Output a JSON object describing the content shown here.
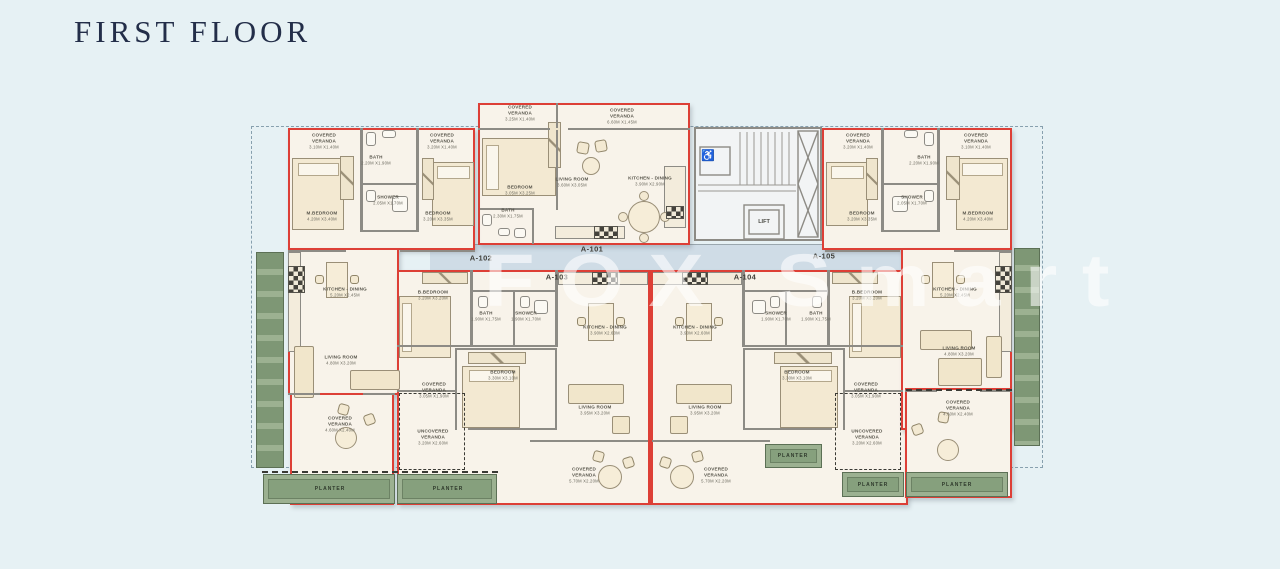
{
  "page": {
    "title": "FIRST FLOOR",
    "watermark": "FOX Smart"
  },
  "colors": {
    "background": "#e6f1f4",
    "unit_outline_red": "#dd3f36",
    "wall_gray": "#8d8b85",
    "room_fill": "#f8f3ea",
    "corridor_fill": "#cfdce6",
    "planter_green": "#9cb191",
    "planter_dark": "#7e9775",
    "title_navy": "#232e49",
    "label_gray": "#57554b",
    "watermark_white": "rgba(255,255,255,0.58)"
  },
  "core": {
    "lift_label": "LIFT",
    "wheelchair_icon": "♿"
  },
  "unit_labels": [
    {
      "text": "A-101",
      "x": 592,
      "y": 249
    },
    {
      "text": "A-102",
      "x": 481,
      "y": 258
    },
    {
      "text": "A-103",
      "x": 557,
      "y": 277
    },
    {
      "text": "A-104",
      "x": 745,
      "y": 277
    },
    {
      "text": "A-105",
      "x": 824,
      "y": 256
    }
  ],
  "planter_labels": [
    {
      "text": "PLANTER",
      "x": 330,
      "y": 489
    },
    {
      "text": "PLANTER",
      "x": 448,
      "y": 489
    },
    {
      "text": "PLANTER",
      "x": 793,
      "y": 456
    },
    {
      "text": "PLANTER",
      "x": 873,
      "y": 485
    },
    {
      "text": "PLANTER",
      "x": 957,
      "y": 485
    }
  ],
  "room_labels": [
    {
      "unit": "A-101",
      "name": "COVERED VERANDA",
      "dims": "3.25m x1.40m",
      "x": 520,
      "y": 113
    },
    {
      "unit": "A-101",
      "name": "COVERED VERANDA",
      "dims": "6.60m x1.45m",
      "x": 622,
      "y": 116
    },
    {
      "unit": "A-101",
      "name": "BEDROOM",
      "dims": "3.05m x3.25m",
      "x": 520,
      "y": 190
    },
    {
      "unit": "A-101",
      "name": "LIVING ROOM",
      "dims": "3.60m x3.05m",
      "x": 572,
      "y": 182
    },
    {
      "unit": "A-101",
      "name": "KITCHEN - DINING",
      "dims": "3.90m x2.90m",
      "x": 650,
      "y": 181
    },
    {
      "unit": "A-101",
      "name": "BATH",
      "dims": "2.30m x1.75m",
      "x": 508,
      "y": 213
    },
    {
      "unit": "A-102",
      "name": "COVERED VERANDA",
      "dims": "3.10m x1.40m",
      "x": 324,
      "y": 141
    },
    {
      "unit": "A-102",
      "name": "BATH",
      "dims": "2.20m x1.90m",
      "x": 376,
      "y": 160
    },
    {
      "unit": "A-102",
      "name": "COVERED VERANDA",
      "dims": "3.20m x1.40m",
      "x": 442,
      "y": 141
    },
    {
      "unit": "A-102",
      "name": "M.BEDROOM",
      "dims": "4.20m x3.40m",
      "x": 322,
      "y": 216
    },
    {
      "unit": "A-102",
      "name": "SHOWER",
      "dims": "2.05m x1.70m",
      "x": 388,
      "y": 200
    },
    {
      "unit": "A-102",
      "name": "BEDROOM",
      "dims": "3.20m x3.35m",
      "x": 438,
      "y": 216
    },
    {
      "unit": "A-102",
      "name": "KITCHEN - DINING",
      "dims": "5.20m x2.45m",
      "x": 345,
      "y": 292
    },
    {
      "unit": "A-102",
      "name": "LIVING ROOM",
      "dims": "4.80m x3.20m",
      "x": 341,
      "y": 360
    },
    {
      "unit": "A-102",
      "name": "COVERED VERANDA",
      "dims": "4.60m x2.40m",
      "x": 340,
      "y": 424
    },
    {
      "unit": "A-103",
      "name": "B.BEDROOM",
      "dims": "3.20m x3.20m",
      "x": 433,
      "y": 295
    },
    {
      "unit": "A-103",
      "name": "BATH",
      "dims": "1.90m x1.75m",
      "x": 486,
      "y": 316
    },
    {
      "unit": "A-103",
      "name": "SHOWER",
      "dims": "1.90m x1.70m",
      "x": 526,
      "y": 316
    },
    {
      "unit": "A-103",
      "name": "KITCHEN - DINING",
      "dims": "3.90m x2.60m",
      "x": 605,
      "y": 330
    },
    {
      "unit": "A-103",
      "name": "BEDROOM",
      "dims": "3.30m x3.10m",
      "x": 503,
      "y": 375
    },
    {
      "unit": "A-103",
      "name": "COVERED VERANDA",
      "dims": "3.05m x1.90m",
      "x": 434,
      "y": 390
    },
    {
      "unit": "A-103",
      "name": "UNCOVERED VERANDA",
      "dims": "3.20m x2.60m",
      "x": 433,
      "y": 437
    },
    {
      "unit": "A-103",
      "name": "LIVING ROOM",
      "dims": "3.95m x3.20m",
      "x": 595,
      "y": 410
    },
    {
      "unit": "A-103",
      "name": "COVERED VERANDA",
      "dims": "5.70m x2.20m",
      "x": 584,
      "y": 475
    },
    {
      "unit": "A-104",
      "name": "KITCHEN - DINING",
      "dims": "3.90m x2.60m",
      "x": 695,
      "y": 330
    },
    {
      "unit": "A-104",
      "name": "SHOWER",
      "dims": "1.90m x1.70m",
      "x": 776,
      "y": 316
    },
    {
      "unit": "A-104",
      "name": "BATH",
      "dims": "1.90m x1.75m",
      "x": 816,
      "y": 316
    },
    {
      "unit": "A-104",
      "name": "B.BEDROOM",
      "dims": "3.20m x3.20m",
      "x": 867,
      "y": 295
    },
    {
      "unit": "A-104",
      "name": "LIVING ROOM",
      "dims": "3.95m x3.20m",
      "x": 705,
      "y": 410
    },
    {
      "unit": "A-104",
      "name": "BEDROOM",
      "dims": "3.30m x3.10m",
      "x": 797,
      "y": 375
    },
    {
      "unit": "A-104",
      "name": "COVERED VERANDA",
      "dims": "3.05m x1.90m",
      "x": 866,
      "y": 390
    },
    {
      "unit": "A-104",
      "name": "UNCOVERED VERANDA",
      "dims": "3.20m x2.60m",
      "x": 867,
      "y": 437
    },
    {
      "unit": "A-104",
      "name": "COVERED VERANDA",
      "dims": "5.70m x2.20m",
      "x": 716,
      "y": 475
    },
    {
      "unit": "A-105",
      "name": "COVERED VERANDA",
      "dims": "3.20m x1.40m",
      "x": 858,
      "y": 141
    },
    {
      "unit": "A-105",
      "name": "BATH",
      "dims": "2.20m x1.90m",
      "x": 924,
      "y": 160
    },
    {
      "unit": "A-105",
      "name": "COVERED VERANDA",
      "dims": "3.10m x1.40m",
      "x": 976,
      "y": 141
    },
    {
      "unit": "A-105",
      "name": "BEDROOM",
      "dims": "3.20m x3.35m",
      "x": 862,
      "y": 216
    },
    {
      "unit": "A-105",
      "name": "SHOWER",
      "dims": "2.05m x1.70m",
      "x": 912,
      "y": 200
    },
    {
      "unit": "A-105",
      "name": "M.BEDROOM",
      "dims": "4.20m x3.40m",
      "x": 978,
      "y": 216
    },
    {
      "unit": "A-105",
      "name": "KITCHEN - DINING",
      "dims": "5.20m x2.45m",
      "x": 955,
      "y": 292
    },
    {
      "unit": "A-105",
      "name": "LIVING ROOM",
      "dims": "4.80m x3.20m",
      "x": 959,
      "y": 351
    },
    {
      "unit": "A-105",
      "name": "COVERED VERANDA",
      "dims": "4.60m x2.40m",
      "x": 958,
      "y": 408
    }
  ]
}
